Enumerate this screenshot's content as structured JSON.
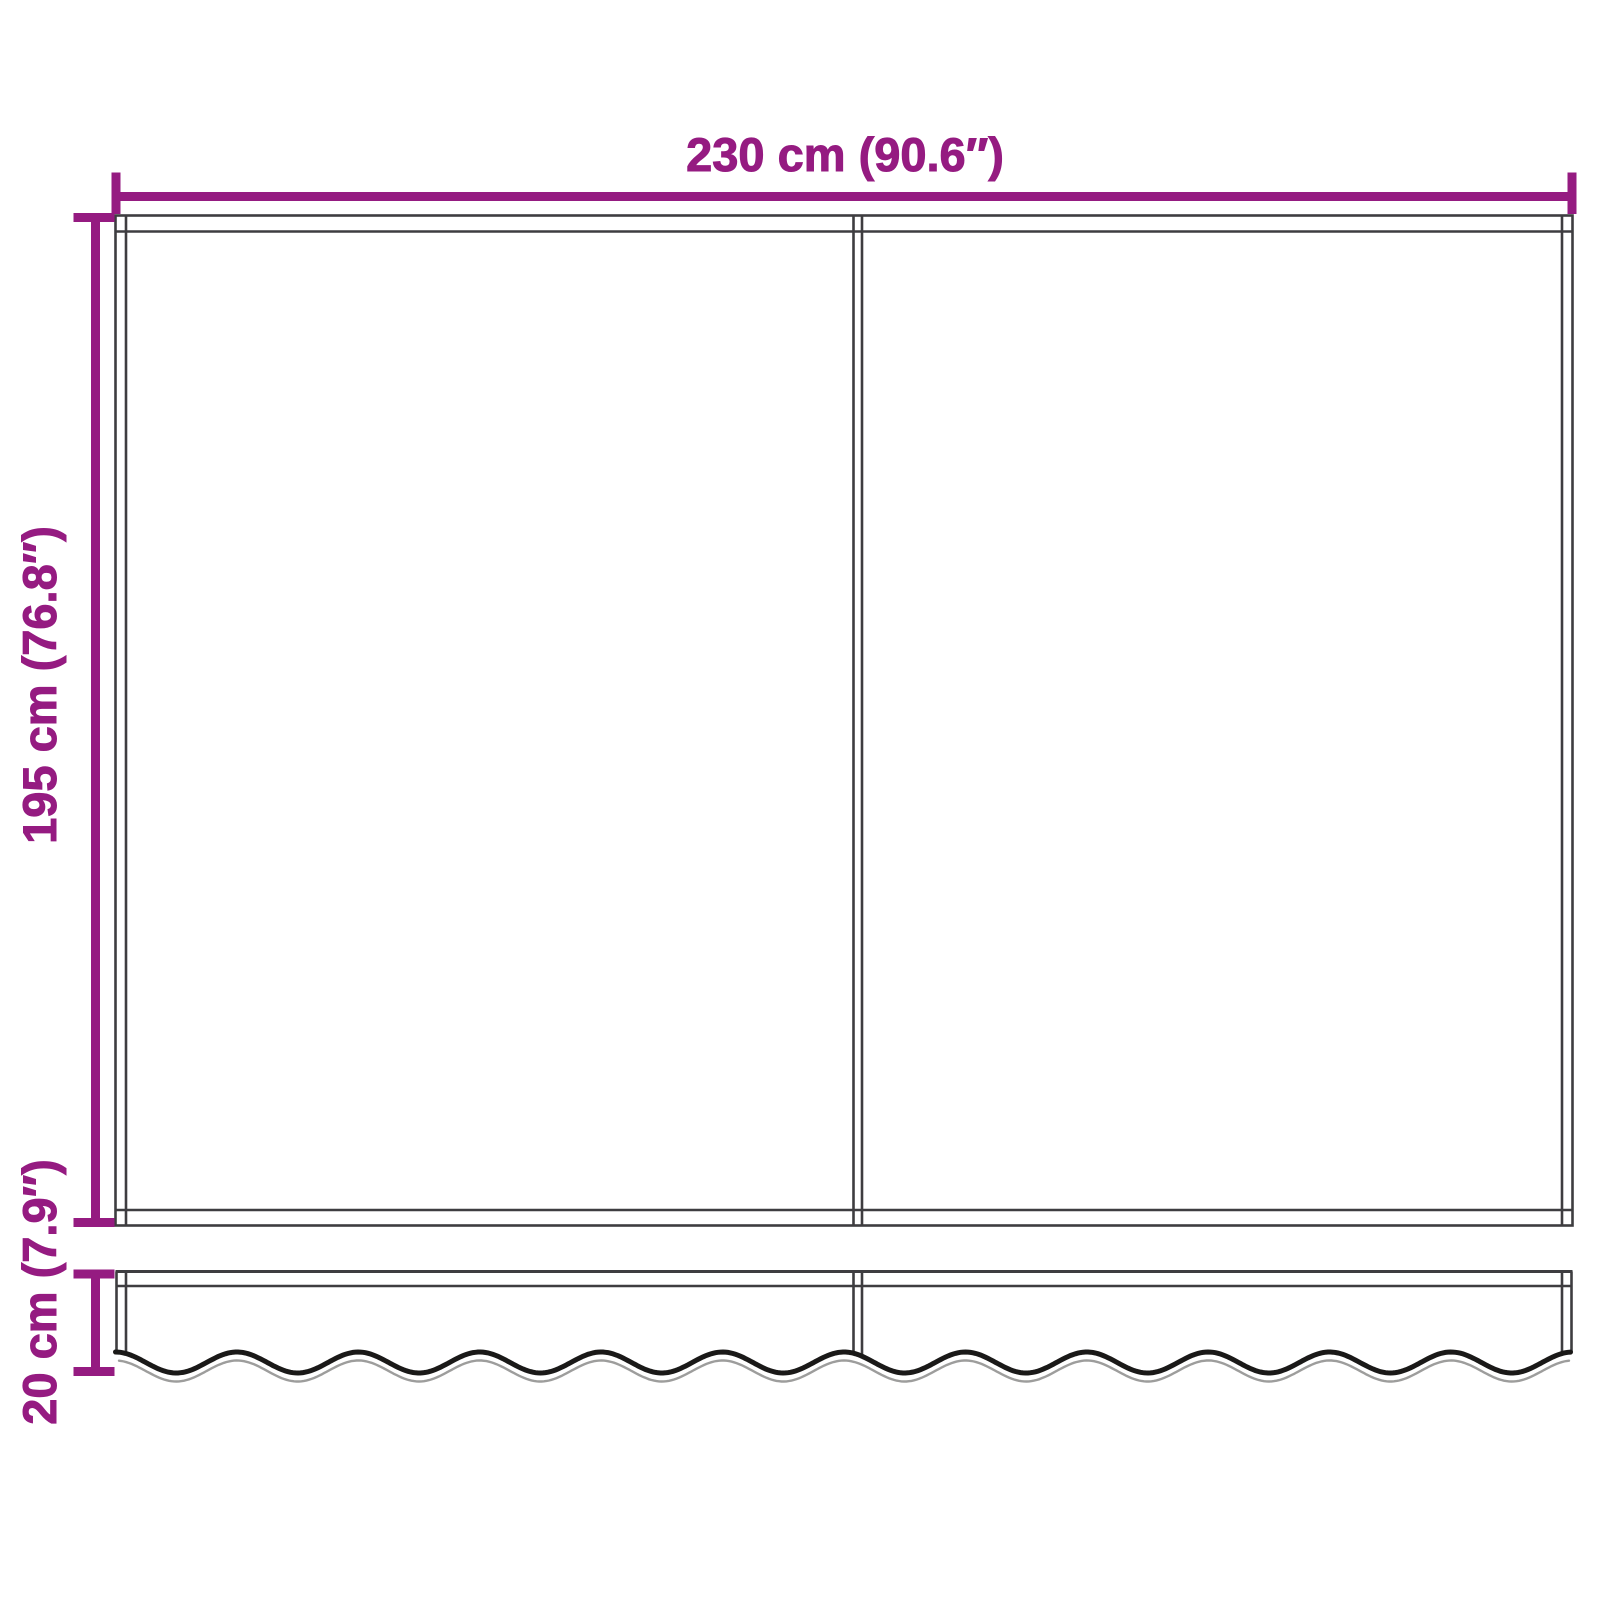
{
  "diagram": {
    "name": "awning-fabric-dimension-diagram",
    "labels": {
      "width": "230 cm (90.6″)",
      "height": "195 cm (76.8″)",
      "valance": "20 cm (7.9″)"
    },
    "colors": {
      "dimension_lines": "#951B81",
      "drawing_outline": "#3E3D40",
      "scallop_dark": "#1A1918",
      "scallop_light": "#9D9D9C",
      "background": "#FFFFFF"
    }
  }
}
